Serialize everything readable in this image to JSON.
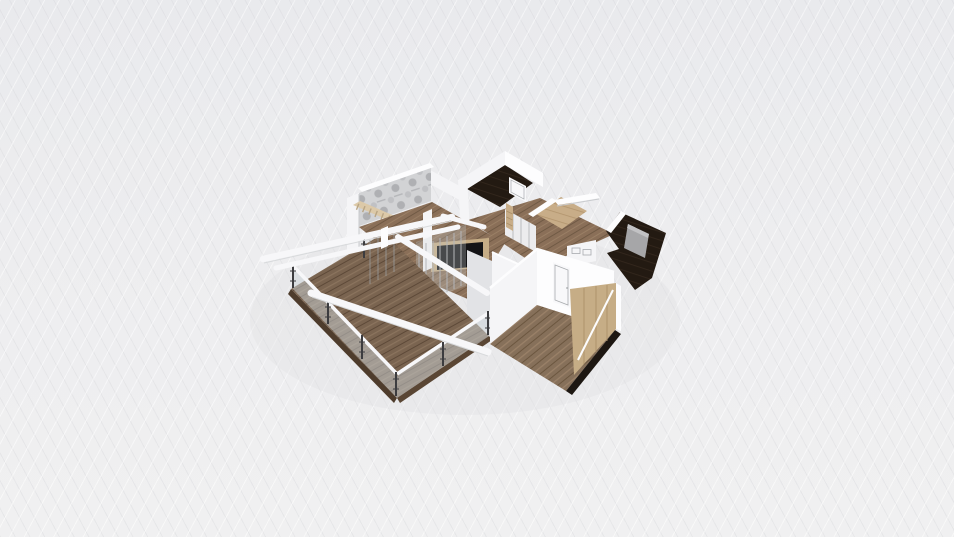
{
  "viewport": {
    "kind": "3d-floorplan-isometric-render",
    "width_px": 954,
    "height_px": 537,
    "background": {
      "top": "#e9eaed",
      "mid": "#ededef",
      "bottom": "#f0f0f1"
    }
  },
  "palette": {
    "wall_white": "#f5f5f7",
    "wall_bright": "#fdfdfe",
    "wall_shade": "#e2e3e6",
    "wall_edge": "#c9cbce",
    "deck_wood": "#7a6450",
    "deck_wood_dark": "#5d4938",
    "deck_wood_light": "#8d765f",
    "deck_fascia_left": "#4e3c2c",
    "deck_fascia_right": "#5a4634",
    "room_wood": "#8a6f58",
    "room_wood_dark": "#6d5742",
    "room_wood_light": "#9c8168",
    "bottom_wood": "#86705a",
    "bottom_wood_dark": "#6b563f",
    "bottom_wood_light": "#9d836a",
    "parquet_light": "#c8ad88",
    "parquet_dark": "#b2946d",
    "dark_floor": "#231a12",
    "dark_floor_light": "#3a2c20",
    "plinth_dark": "#1d1712",
    "marble_base": "#d2d3d5",
    "marble_vein": "#97999d",
    "marble_vein_soft": "#b9babe",
    "glass": "#ccd4d8",
    "railing_post": "#3c3c3f",
    "wire": "#9a9c9e",
    "beam_white": "#f7f7f9",
    "beam_edge": "#d8dadc",
    "tv_screen": "#141416",
    "wood_panel": "#c6ad86",
    "wood_panel_grain": "#ab9069",
    "gray_panel": "#a6a6a8",
    "gray_panel_top": "#c2c2c4",
    "door_face": "#f8f8fa",
    "door_frame": "#a8abae",
    "shadow": "#dfe0e2",
    "slats_wood": "#dcc9a8",
    "slats_rung": "#b9a584",
    "closet_front": "#ececee",
    "closet_divider": "#b5b7ba",
    "mullion": "#b4b6b9"
  },
  "scene": {
    "areas": [
      {
        "name": "terrace-deck",
        "floor": "deck_wood",
        "elements": [
          "glass-railing",
          "metal-posts",
          "white-pergola-beams",
          "dark-fascia"
        ]
      },
      {
        "name": "living-room",
        "floor": "room_wood",
        "elements": [
          "tv-media-wall",
          "window-mullions",
          "white-columns"
        ]
      },
      {
        "name": "marble-wall-room",
        "floor": "room_wood",
        "elements": [
          "marble-accent-wall",
          "pergola-slats"
        ]
      },
      {
        "name": "dark-floor-room-top",
        "floor": "dark_floor",
        "elements": [
          "white-door",
          "sliding-wardrobe",
          "shelf-column"
        ]
      },
      {
        "name": "parquet-nook",
        "floor": "parquet_light",
        "elements": [
          "white-floating-shelf"
        ]
      },
      {
        "name": "dark-floor-room-right",
        "floor": "dark_floor",
        "elements": [
          "gray-furniture-panel",
          "white-walls"
        ]
      },
      {
        "name": "bottom-room",
        "floor": "bottom_wood",
        "elements": [
          "white-door",
          "wood-glass-partition",
          "dark-plinth"
        ]
      }
    ]
  }
}
